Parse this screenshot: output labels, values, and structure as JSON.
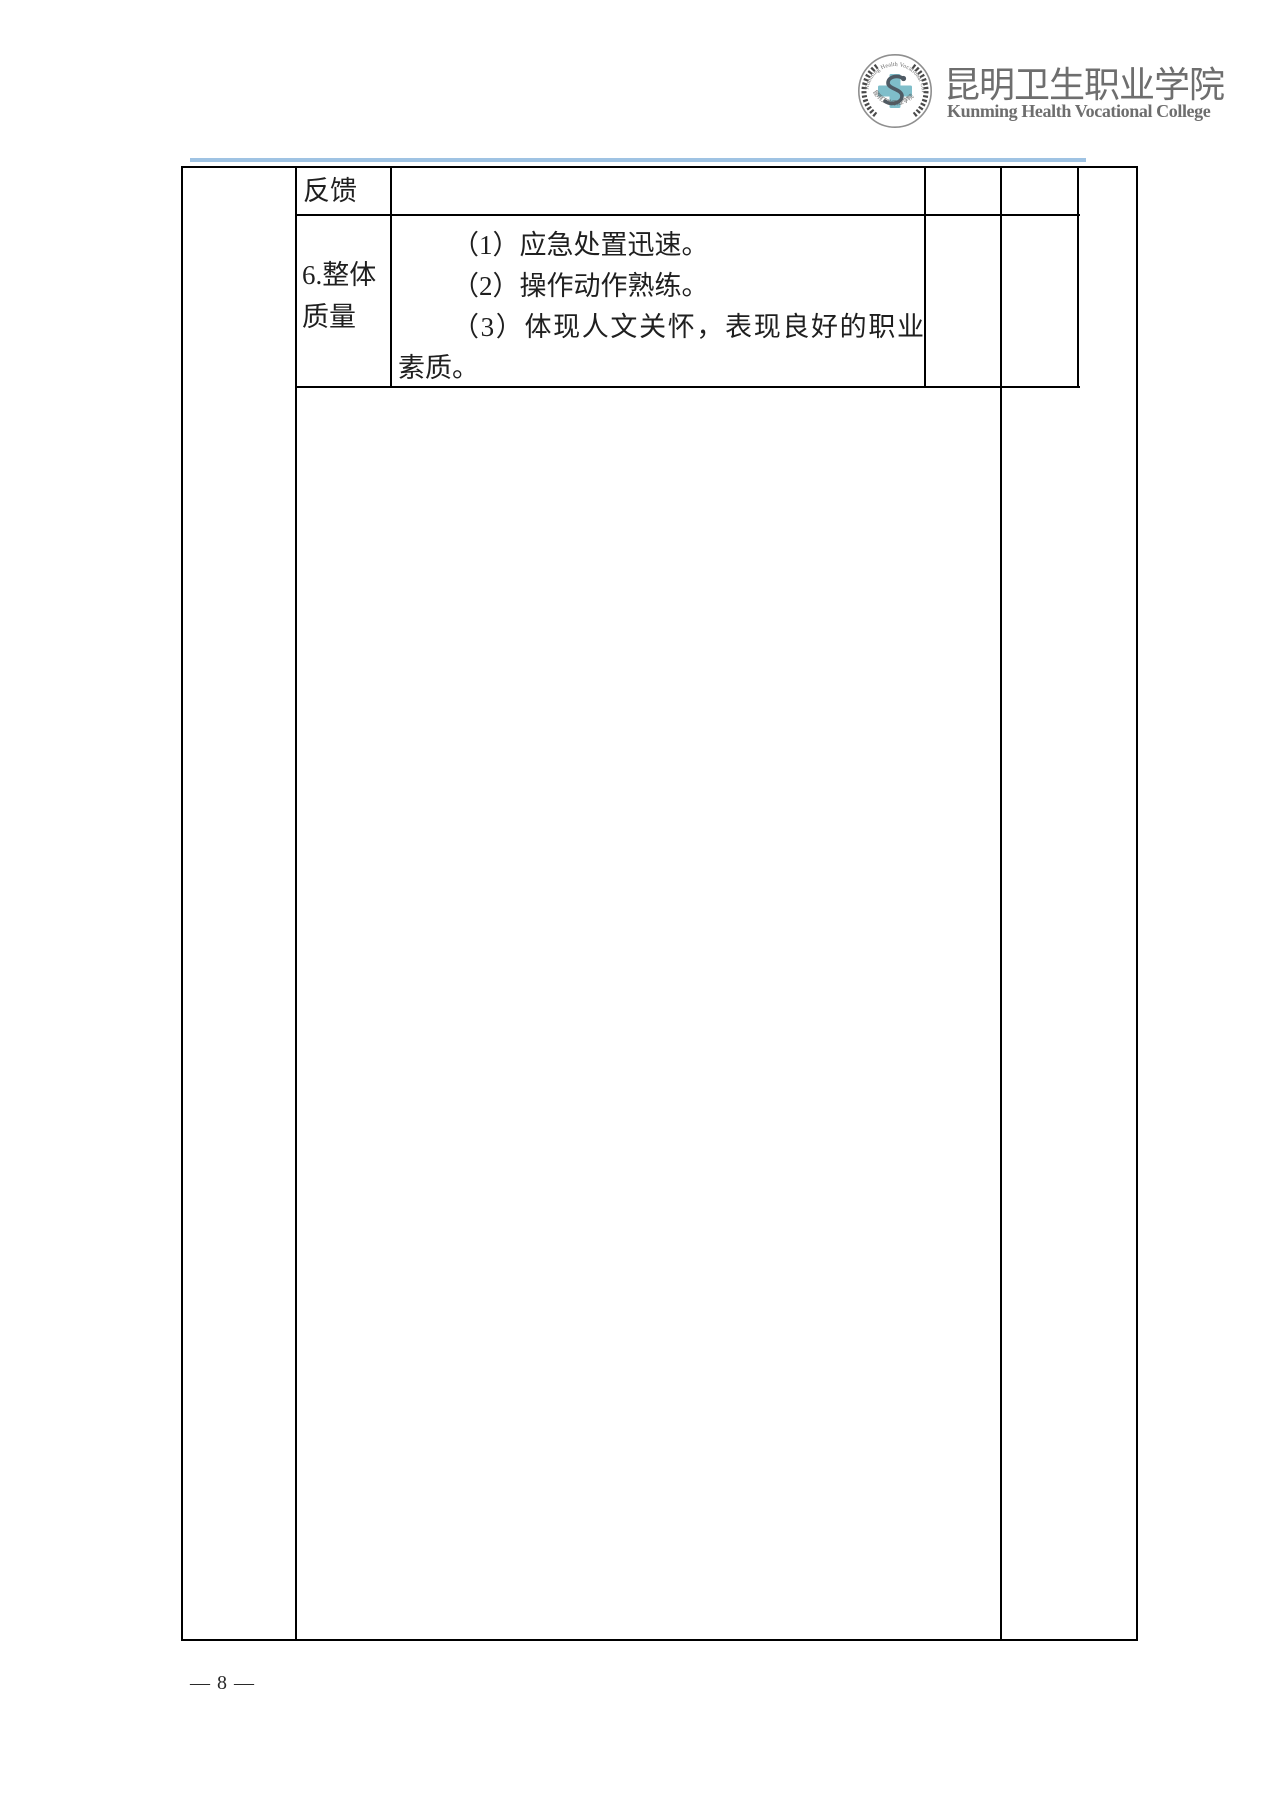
{
  "header": {
    "college_name_zh": "昆明卫生职业学院",
    "college_name_en": "Kunming Health Vocational College",
    "logo": {
      "arc_text_top": "Kunming Health Vocational College",
      "arc_text_bottom": "昆明卫生职业学院",
      "cross_color": "#7fbeca",
      "ring_color": "#8f8f8f",
      "wreath_color": "#4a4a4a"
    }
  },
  "accent_line_color": "#9fc3e3",
  "table": {
    "feedback_row": {
      "label": "反馈",
      "content": ""
    },
    "quality_row": {
      "label": "6.整体质量",
      "items": [
        "（1）应急处置迅速。",
        "（2）操作动作熟练。",
        "（3）体现人文关怀，表现良好的职业素质。"
      ]
    }
  },
  "footer": {
    "page_number": "— 8 —"
  },
  "colors": {
    "border": "#000000",
    "text": "#1f1f1f",
    "header_text": "#6e6e6e"
  }
}
